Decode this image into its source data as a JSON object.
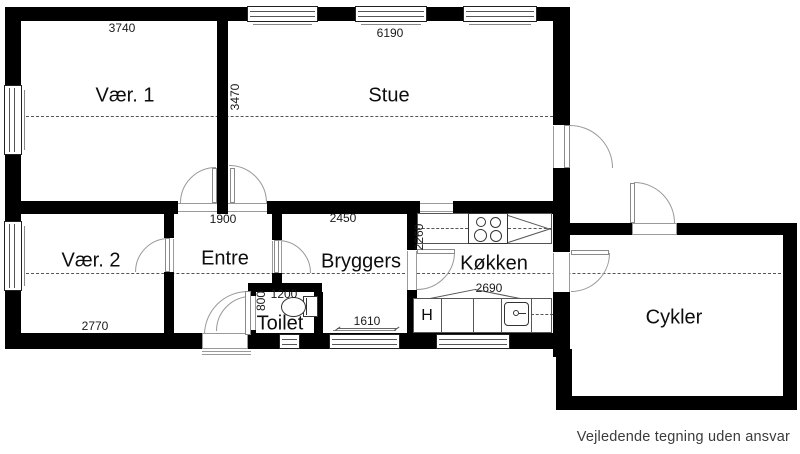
{
  "rooms": {
    "vaer1": {
      "label": "Vær. 1",
      "width_mm": "3740"
    },
    "stue": {
      "label": "Stue",
      "width_mm": "6190",
      "height_mm": "3470"
    },
    "vaer2": {
      "label": "Vær. 2",
      "width_mm": "2770"
    },
    "entre": {
      "label": "Entre",
      "width_mm": "1900"
    },
    "bryggers": {
      "label": "Bryggers",
      "width_mm": "2450",
      "window_mm": "1610"
    },
    "koekken": {
      "label": "Køkken",
      "width_mm": "2690",
      "height_mm": "2260"
    },
    "toilet": {
      "label": "Toilet",
      "width_mm": "1200",
      "height_mm": "800"
    },
    "cykler": {
      "label": "Cykler"
    }
  },
  "fixtures": {
    "heater_label": "H"
  },
  "footer": {
    "disclaimer": "Vejledende tegning uden ansvar"
  },
  "colors": {
    "wall": "#000000",
    "door_line": "#999999",
    "dash_line": "#555555",
    "text": "#0d0d0d",
    "footer_text": "#3b3b3b",
    "background": "#ffffff"
  }
}
